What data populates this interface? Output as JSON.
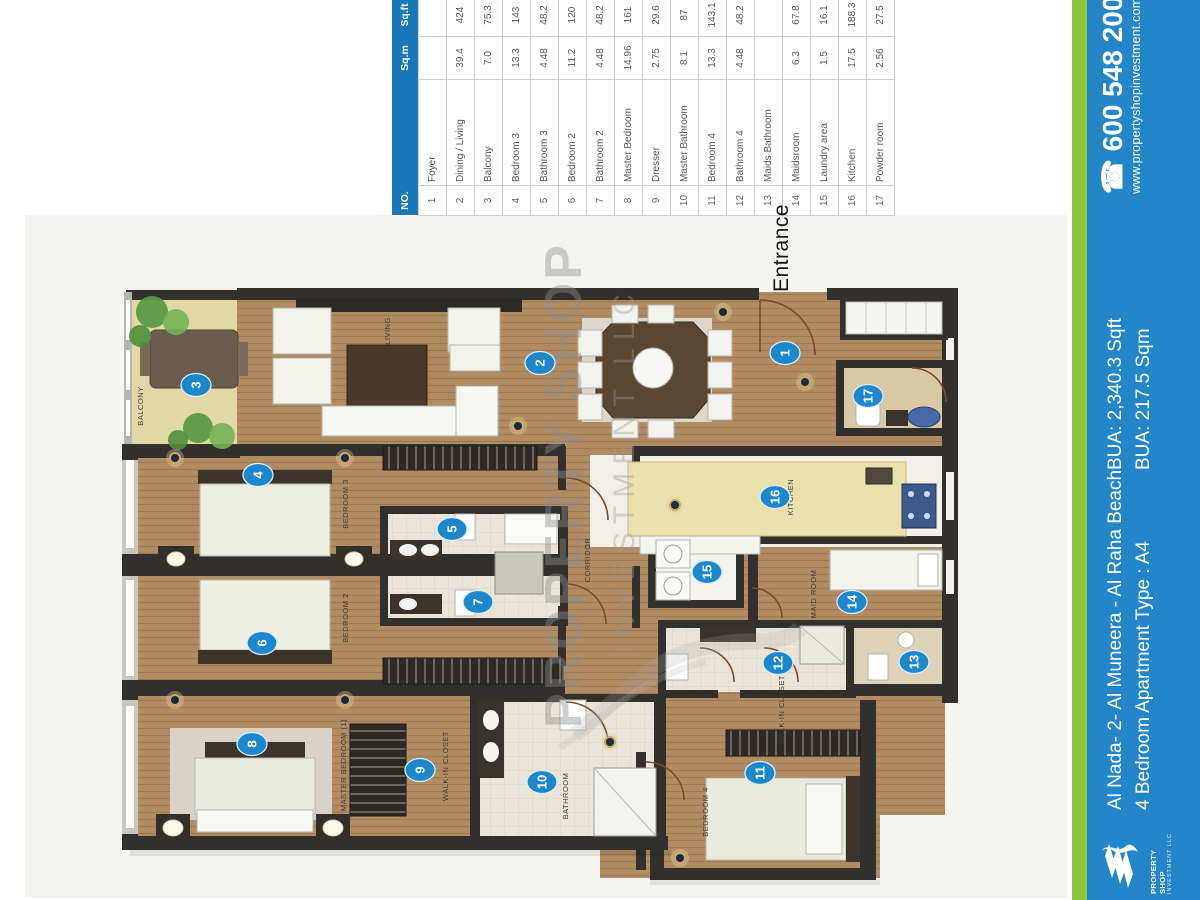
{
  "table": {
    "headers": {
      "no": "NO.",
      "name": "",
      "sqm": "Sq.m",
      "sqft": "Sq.ft"
    },
    "rows": [
      {
        "no": "1",
        "name": "Foyer",
        "sqm": "",
        "sqft": ""
      },
      {
        "no": "2",
        "name": "Dining / Living",
        "sqm": "39.4",
        "sqft": "424"
      },
      {
        "no": "3",
        "name": "Balcony",
        "sqm": "7.0",
        "sqft": "75.3"
      },
      {
        "no": "4",
        "name": "Bedroom 3",
        "sqm": "13.3",
        "sqft": "143"
      },
      {
        "no": "5",
        "name": "Bathroom 3",
        "sqm": "4.48",
        "sqft": "48.2"
      },
      {
        "no": "6",
        "name": "Bedroom 2",
        "sqm": "11.2",
        "sqft": "120"
      },
      {
        "no": "7",
        "name": "Bathroom 2",
        "sqm": "4.48",
        "sqft": "48.2"
      },
      {
        "no": "8",
        "name": "Master Bedroom",
        "sqm": "14.96",
        "sqft": "161"
      },
      {
        "no": "9",
        "name": "Dresser",
        "sqm": "2.75",
        "sqft": "29.6"
      },
      {
        "no": "10",
        "name": "Master Bathroom",
        "sqm": "8.1",
        "sqft": "87"
      },
      {
        "no": "11",
        "name": "Bedroom 4",
        "sqm": "13.3",
        "sqft": "143.1"
      },
      {
        "no": "12",
        "name": "Bathroom 4",
        "sqm": "4.48",
        "sqft": "48.2"
      },
      {
        "no": "13",
        "name": "Maids Bathroom",
        "sqm": "",
        "sqft": ""
      },
      {
        "no": "14",
        "name": "Maidsroom",
        "sqm": "6.3",
        "sqft": "67.8"
      },
      {
        "no": "15",
        "name": "Laundry area",
        "sqm": "1.5",
        "sqft": "16.1"
      },
      {
        "no": "16",
        "name": "Kitchen",
        "sqm": "17.5",
        "sqft": "188.3"
      },
      {
        "no": "17",
        "name": "Powder room",
        "sqm": "2.56",
        "sqft": "27.5"
      }
    ]
  },
  "plan": {
    "entrance_label": "Entrance",
    "watermark_line1": "PROPERTY SHOP",
    "watermark_line2": "INVESTMENT LLC",
    "room_labels": [
      "BALCONY",
      "LIVING",
      "BEDROOM 3",
      "BEDROOM 2",
      "MASTER BEDROOM (1)",
      "WALK-IN CLOSET",
      "BATHROOM",
      "CORRIDOR",
      "KITCHEN",
      "MAID ROOM",
      "WALK-IN CLOSET",
      "BEDROOM 4"
    ]
  },
  "sidebar": {
    "phone": "600 548 200",
    "website": "www.propertyshopinvestment.com",
    "bua_sqft": "BUA: 2,340.3 Sqft",
    "bua_sqm": "BUA: 217.5 Sqm",
    "project": "Al Nada- 2- Al Muneera - Al Raha Beach",
    "apartment_type": "4 Bedroom Apartment Type : A4",
    "logo_line1": "PROPERTY SHOP",
    "logo_line2": "INVESTMENT LLC",
    "colors": {
      "bar_blue": "#2386c8",
      "stripe_green": "#8cc63e",
      "table_header_blue": "#1878b8",
      "marker_blue": "#1d87cb"
    }
  },
  "icons": {
    "phone": "☎"
  }
}
